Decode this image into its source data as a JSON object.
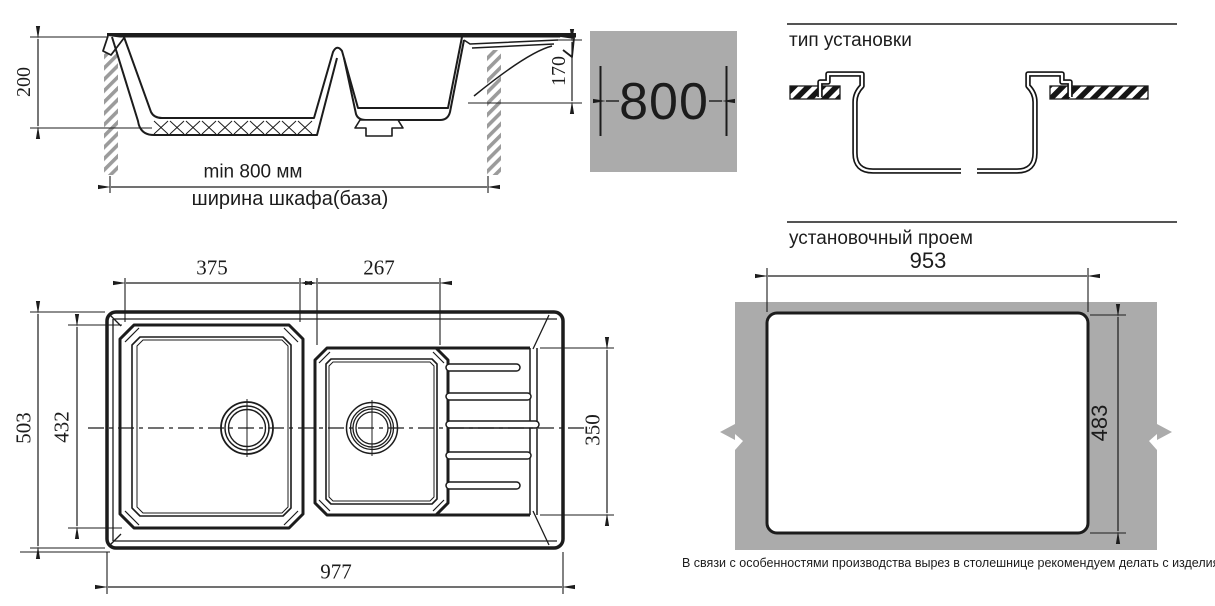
{
  "side_view": {
    "depth_overall": "200",
    "depth_small_bowl": "170",
    "min_width": "min 800 мм",
    "cabinet_width_label": "ширина шкафа(база)"
  },
  "cabinet_badge": {
    "value": "800",
    "bg_color": "#ababab"
  },
  "install_type": {
    "title": "тип установки"
  },
  "top_view": {
    "bowl1_width": "375",
    "bowl2_width": "267",
    "overall_depth": "503",
    "bowl1_depth": "432",
    "drainer_depth": "350",
    "overall_width": "977"
  },
  "cutout": {
    "title": "установочный проем",
    "width": "953",
    "height": "483",
    "note": "В связи с особенностями производства вырез в столешнице рекомендуем делать с изделия.",
    "countertop_color": "#ababab"
  },
  "colors": {
    "line": "#1c1c1c",
    "gray": "#ababab"
  }
}
